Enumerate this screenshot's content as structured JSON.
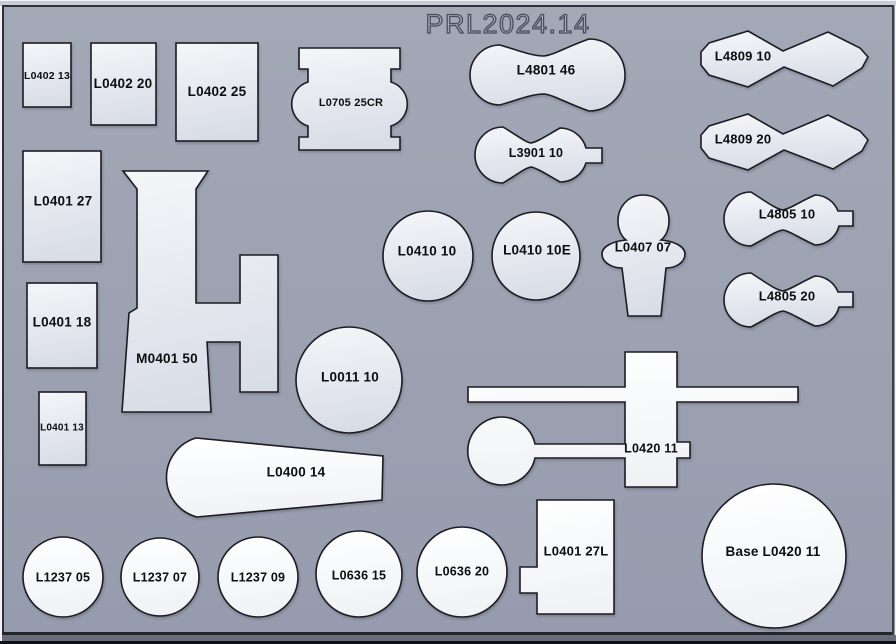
{
  "title": "PRL2024.14",
  "colors": {
    "board_bg": "#9ba1b1",
    "part_fill_light_top": "#f4f6f9",
    "part_fill_light_bottom": "#d9dde6",
    "part_fill_white_top": "#ffffff",
    "part_fill_white_bottom": "#f0f2f6",
    "part_stroke": "#1b1c20",
    "label_text": "#0d0e10",
    "title_outline": "#4a4e59",
    "board_edge_dark": "#2e3138",
    "board_bottom_shadow": "#686c7b"
  },
  "parts": [
    {
      "id": "L0402-13",
      "label": "L0402 13"
    },
    {
      "id": "L0402-20",
      "label": "L0402 20"
    },
    {
      "id": "L0402-25",
      "label": "L0402 25"
    },
    {
      "id": "L0705-25CR",
      "label": "L0705 25CR"
    },
    {
      "id": "L4801-46",
      "label": "L4801 46"
    },
    {
      "id": "L3901-10",
      "label": "L3901 10"
    },
    {
      "id": "L4809-10",
      "label": "L4809 10"
    },
    {
      "id": "L4809-20",
      "label": "L4809 20"
    },
    {
      "id": "L0401-27",
      "label": "L0401 27"
    },
    {
      "id": "L0401-18",
      "label": "L0401 18"
    },
    {
      "id": "L0401-13",
      "label": "L0401 13"
    },
    {
      "id": "M0401-50",
      "label": "M0401 50"
    },
    {
      "id": "L0410-10",
      "label": "L0410 10"
    },
    {
      "id": "L0410-10E",
      "label": "L0410 10E"
    },
    {
      "id": "L0407-07",
      "label": "L0407 07"
    },
    {
      "id": "L4805-10",
      "label": "L4805 10"
    },
    {
      "id": "L4805-20",
      "label": "L4805 20"
    },
    {
      "id": "L0011-10",
      "label": "L0011 10"
    },
    {
      "id": "L0400-14",
      "label": "L0400 14"
    },
    {
      "id": "L0420-11",
      "label": "L0420 11"
    },
    {
      "id": "L1237-05",
      "label": "L1237 05"
    },
    {
      "id": "L1237-07",
      "label": "L1237 07"
    },
    {
      "id": "L1237-09",
      "label": "L1237 09"
    },
    {
      "id": "L0636-15",
      "label": "L0636 15"
    },
    {
      "id": "L0636-20",
      "label": "L0636 20"
    },
    {
      "id": "L0401-27L",
      "label": "L0401 27L"
    },
    {
      "id": "Base-L0420-11",
      "label": "Base L0420 11"
    }
  ]
}
